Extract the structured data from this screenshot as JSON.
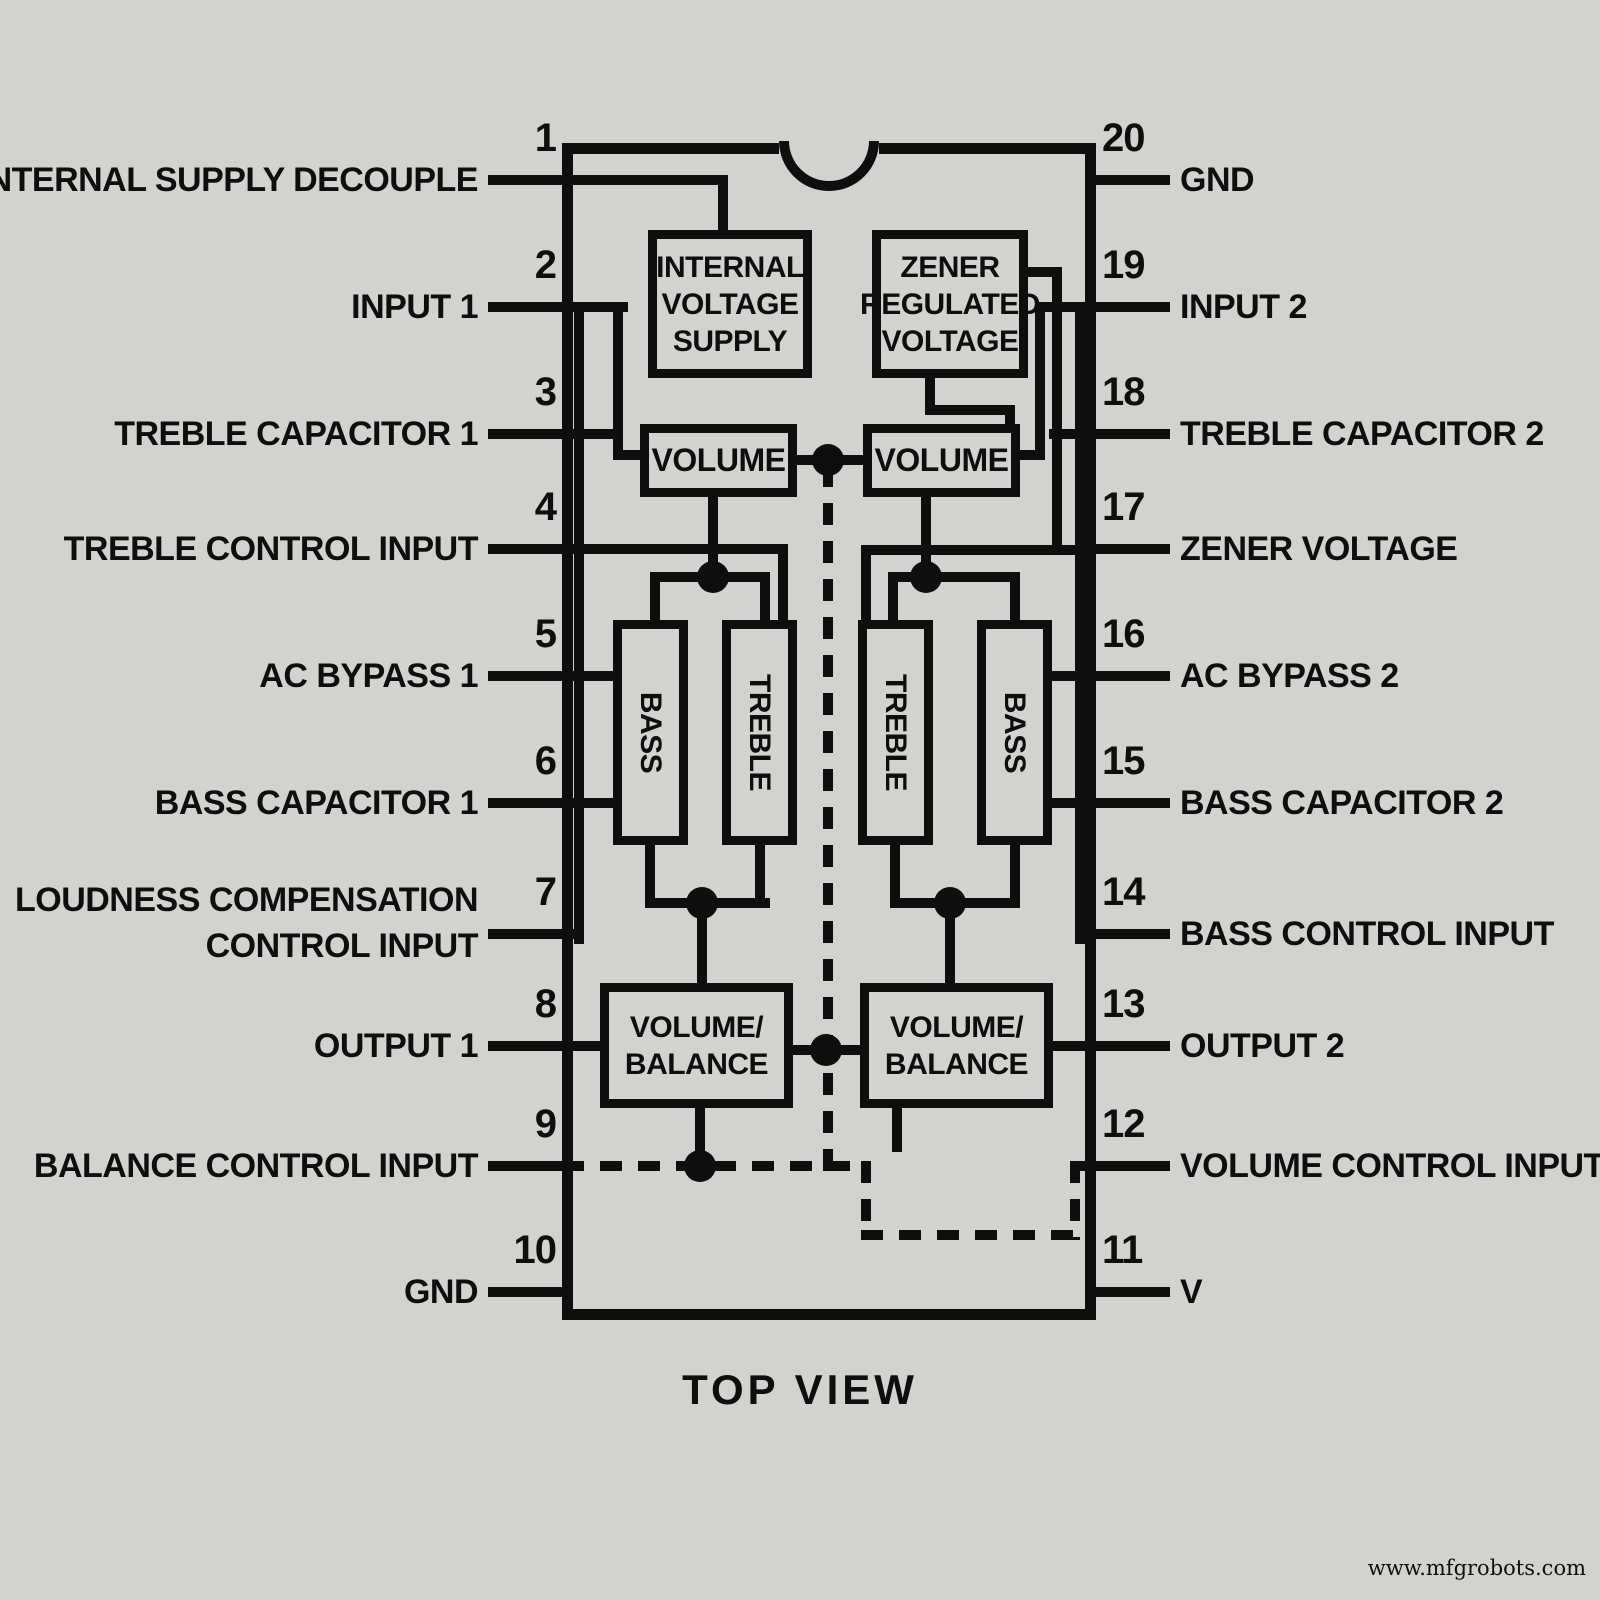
{
  "title": "TOP VIEW",
  "watermark": "www.mfgrobots.com",
  "colors": {
    "bg": "#d2d2cf",
    "ink": "#0e0e0e"
  },
  "package": {
    "x": 562,
    "y": 143,
    "w": 534,
    "h": 1177,
    "border": 11,
    "notch": {
      "x": 779,
      "y": 141,
      "w": 100,
      "h": 50
    }
  },
  "pins_left": [
    {
      "num": "1",
      "y": 180,
      "lines": [
        "INTERNAL SUPPLY DECOUPLE"
      ]
    },
    {
      "num": "2",
      "y": 307,
      "lines": [
        "INPUT 1"
      ]
    },
    {
      "num": "3",
      "y": 434,
      "lines": [
        "TREBLE CAPACITOR 1"
      ]
    },
    {
      "num": "4",
      "y": 549,
      "lines": [
        "TREBLE CONTROL INPUT"
      ]
    },
    {
      "num": "5",
      "y": 676,
      "lines": [
        "AC BYPASS 1"
      ]
    },
    {
      "num": "6",
      "y": 803,
      "lines": [
        "BASS CAPACITOR 1"
      ]
    },
    {
      "num": "7",
      "y": 934,
      "lines": [
        "LOUDNESS COMPENSATION",
        "CONTROL INPUT"
      ]
    },
    {
      "num": "8",
      "y": 1046,
      "lines": [
        "OUTPUT 1"
      ]
    },
    {
      "num": "9",
      "y": 1166,
      "lines": [
        "BALANCE CONTROL INPUT"
      ]
    },
    {
      "num": "10",
      "y": 1292,
      "lines": [
        "GND"
      ]
    }
  ],
  "pins_right": [
    {
      "num": "20",
      "y": 180,
      "lines": [
        "GND"
      ]
    },
    {
      "num": "19",
      "y": 307,
      "lines": [
        "INPUT 2"
      ]
    },
    {
      "num": "18",
      "y": 434,
      "lines": [
        "TREBLE CAPACITOR 2"
      ]
    },
    {
      "num": "17",
      "y": 549,
      "lines": [
        "ZENER VOLTAGE"
      ]
    },
    {
      "num": "16",
      "y": 676,
      "lines": [
        "AC BYPASS 2"
      ]
    },
    {
      "num": "15",
      "y": 803,
      "lines": [
        "BASS CAPACITOR 2"
      ]
    },
    {
      "num": "14",
      "y": 934,
      "lines": [
        "BASS CONTROL INPUT"
      ]
    },
    {
      "num": "13",
      "y": 1046,
      "lines": [
        "OUTPUT 2"
      ]
    },
    {
      "num": "12",
      "y": 1166,
      "lines": [
        "VOLUME CONTROL INPUT"
      ]
    },
    {
      "num": "11",
      "y": 1292,
      "lines": [
        "V"
      ],
      "sub": "CC"
    }
  ],
  "blocks": [
    {
      "name": "internal-voltage-supply",
      "x": 648,
      "y": 230,
      "w": 164,
      "h": 148,
      "lines": [
        "INTERNAL",
        "VOLTAGE",
        "SUPPLY"
      ]
    },
    {
      "name": "zener-regulated-voltage",
      "x": 872,
      "y": 230,
      "w": 156,
      "h": 148,
      "lines": [
        "ZENER",
        "REGULATED",
        "VOLTAGE"
      ]
    },
    {
      "name": "volume-1",
      "x": 640,
      "y": 424,
      "w": 157,
      "h": 73,
      "vol": true,
      "lines": [
        "VOLUME"
      ]
    },
    {
      "name": "volume-2",
      "x": 863,
      "y": 424,
      "w": 157,
      "h": 73,
      "vol": true,
      "lines": [
        "VOLUME"
      ]
    },
    {
      "name": "bass-1",
      "x": 613,
      "y": 620,
      "w": 75,
      "h": 225,
      "vertical": true,
      "lines": [
        "BASS"
      ]
    },
    {
      "name": "treble-1",
      "x": 722,
      "y": 620,
      "w": 75,
      "h": 225,
      "vertical": true,
      "lines": [
        "TREBLE"
      ]
    },
    {
      "name": "treble-2",
      "x": 858,
      "y": 620,
      "w": 75,
      "h": 225,
      "vertical": true,
      "lines": [
        "TREBLE"
      ]
    },
    {
      "name": "bass-2",
      "x": 977,
      "y": 620,
      "w": 75,
      "h": 225,
      "vertical": true,
      "lines": [
        "BASS"
      ]
    },
    {
      "name": "volume-balance-1",
      "x": 600,
      "y": 983,
      "w": 193,
      "h": 125,
      "lines": [
        "VOLUME/",
        "BALANCE"
      ]
    },
    {
      "name": "volume-balance-2",
      "x": 860,
      "y": 983,
      "w": 193,
      "h": 125,
      "lines": [
        "VOLUME/",
        "BALANCE"
      ]
    }
  ],
  "wires": {
    "solid": [
      [
        562,
        175,
        166,
        10
      ],
      [
        718,
        175,
        10,
        65
      ],
      [
        562,
        302,
        66,
        10
      ],
      [
        613,
        302,
        10,
        158
      ],
      [
        613,
        450,
        32,
        10
      ],
      [
        574,
        302,
        10,
        642
      ],
      [
        562,
        429,
        60,
        10
      ],
      [
        562,
        544,
        226,
        10
      ],
      [
        778,
        544,
        10,
        82
      ],
      [
        562,
        671,
        56,
        10
      ],
      [
        562,
        798,
        56,
        10
      ],
      [
        562,
        929,
        22,
        10
      ],
      [
        562,
        1041,
        44,
        10
      ],
      [
        708,
        497,
        10,
        85
      ],
      [
        650,
        572,
        120,
        10
      ],
      [
        650,
        572,
        10,
        53
      ],
      [
        760,
        572,
        10,
        53
      ],
      [
        645,
        845,
        10,
        63
      ],
      [
        755,
        845,
        10,
        63
      ],
      [
        645,
        898,
        125,
        10
      ],
      [
        697,
        898,
        10,
        90
      ],
      [
        695,
        1108,
        10,
        58
      ],
      [
        797,
        455,
        66,
        10
      ],
      [
        793,
        1045,
        67,
        10
      ],
      [
        1035,
        302,
        61,
        10
      ],
      [
        1035,
        302,
        10,
        158
      ],
      [
        1015,
        450,
        30,
        10
      ],
      [
        1075,
        302,
        10,
        642
      ],
      [
        1049,
        429,
        47,
        10
      ],
      [
        1028,
        267,
        34,
        10
      ],
      [
        1052,
        267,
        10,
        288
      ],
      [
        861,
        545,
        235,
        10
      ],
      [
        861,
        545,
        10,
        81
      ],
      [
        925,
        378,
        10,
        37
      ],
      [
        925,
        405,
        90,
        10
      ],
      [
        1005,
        405,
        10,
        25
      ],
      [
        1052,
        671,
        44,
        10
      ],
      [
        1052,
        798,
        44,
        10
      ],
      [
        1075,
        929,
        21,
        10
      ],
      [
        1053,
        1041,
        43,
        10
      ],
      [
        921,
        497,
        10,
        85
      ],
      [
        888,
        572,
        132,
        10
      ],
      [
        888,
        572,
        10,
        53
      ],
      [
        1010,
        572,
        10,
        53
      ],
      [
        890,
        845,
        10,
        63
      ],
      [
        1010,
        845,
        10,
        63
      ],
      [
        890,
        898,
        130,
        10
      ],
      [
        945,
        898,
        10,
        90
      ],
      [
        892,
        1108,
        10,
        44
      ],
      [
        1080,
        1161,
        16,
        10
      ]
    ],
    "dashed": [
      [
        823,
        465,
        10,
        706
      ],
      [
        562,
        1161,
        304,
        10
      ],
      [
        861,
        1161,
        10,
        79
      ],
      [
        861,
        1230,
        219,
        10
      ],
      [
        1070,
        1161,
        10,
        79
      ]
    ],
    "dash": 22,
    "gap": 16,
    "pin_len": 74,
    "thickness": 10
  },
  "dots": [
    [
      828,
      460
    ],
    [
      713,
      577
    ],
    [
      926,
      577
    ],
    [
      702,
      903
    ],
    [
      950,
      903
    ],
    [
      826,
      1050
    ],
    [
      700,
      1166
    ]
  ],
  "dot_r": 16
}
